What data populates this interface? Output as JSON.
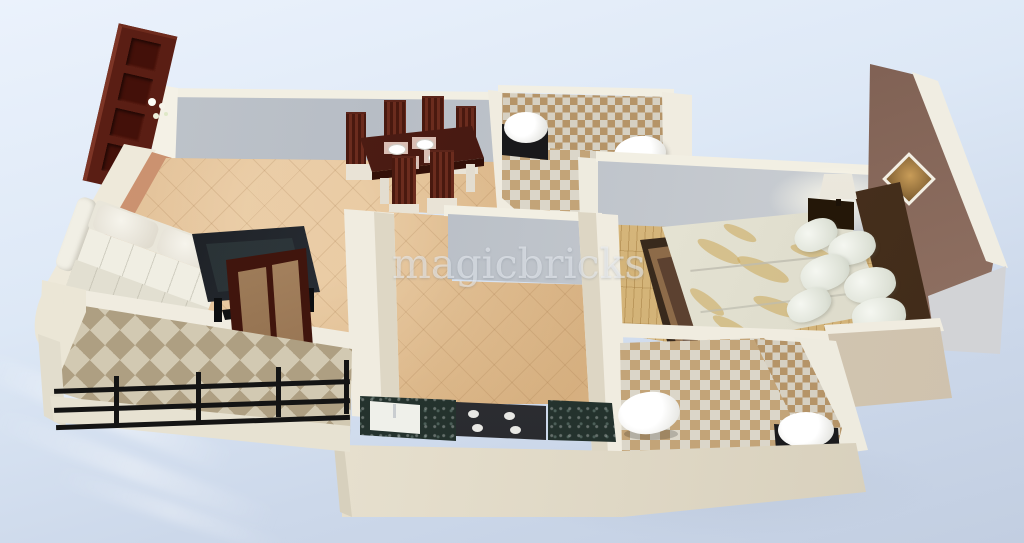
{
  "watermark": {
    "text": "magicbricks"
  },
  "scene": {
    "description": "3d-isometric-floor-plan-render",
    "rooms": [
      "living-room",
      "dining-area",
      "kitchen",
      "bedroom",
      "bathroom-top",
      "bathroom-bottom",
      "balcony"
    ]
  },
  "colors": {
    "cream": "#f0ece0",
    "strip": "#f2efe3",
    "gray1": "#b7bdc5",
    "gray2": "#d2d5d8",
    "tan1": "#dcb88e",
    "tan2": "#d2a977",
    "wood": "#d9ba80",
    "orange1": "#cf9674",
    "orange2": "#b97f5e",
    "brown1": "#6e5044",
    "brown2": "#8d6e60",
    "maroon": "#5a1e14",
    "granite": "#22302b",
    "rail": "#141414",
    "checkd": "#b59468",
    "checkl": "#d6d0c2",
    "checkd2": "#c3a478",
    "checkl2": "#dbd6c9",
    "diam1": "#ae9f82",
    "diam2": "#d2c9b2"
  }
}
